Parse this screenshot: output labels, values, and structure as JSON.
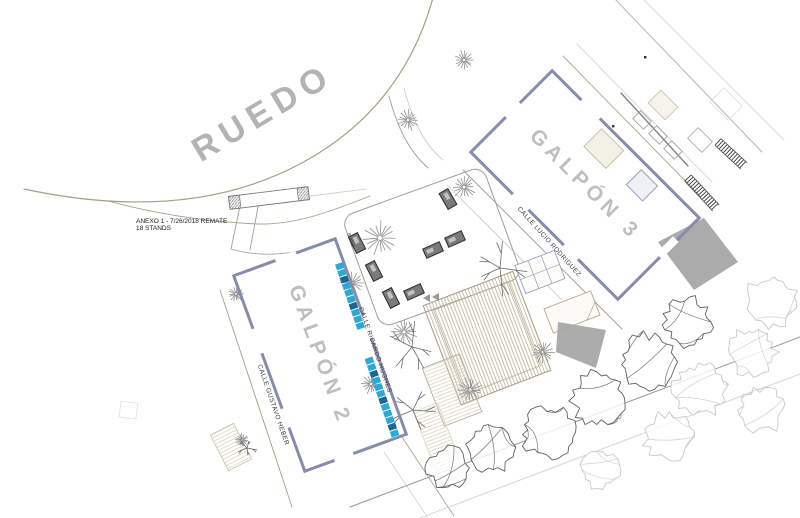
{
  "ruedo_label": "RUEDO",
  "annotation": {
    "line1": "ANEXO 1 - 7/26/2018 REMATE",
    "line2": "18 STANDS"
  },
  "buildings": {
    "galpon2": {
      "label": "GALPÓN 2"
    },
    "galpon3": {
      "label": "GALPÓN 3"
    }
  },
  "streets": {
    "gustavo_heber": {
      "label": "CALLE GUSTAVO HEBER"
    },
    "ricardo_hughes": {
      "label": "CALLE RICARDO HUGHES"
    },
    "lucio_rodriguez": {
      "label": "CALLE LUCIO RODRIGUEZ"
    }
  },
  "small_labels": {
    "batm": "B.ATM"
  },
  "stands": {
    "strip1_count": 10,
    "strip2_count": 12
  },
  "colors": {
    "stand_cyan": "#2ea7d6",
    "stand_dark": "#19688f",
    "wall_blue": "#878cab",
    "label_gray": "#bfbfbf",
    "road_tan": "#a89d85",
    "line_gray": "#9b9b9b",
    "kiosk_gray": "#7a7a7a",
    "shade_gray": "#a0a0a0"
  }
}
